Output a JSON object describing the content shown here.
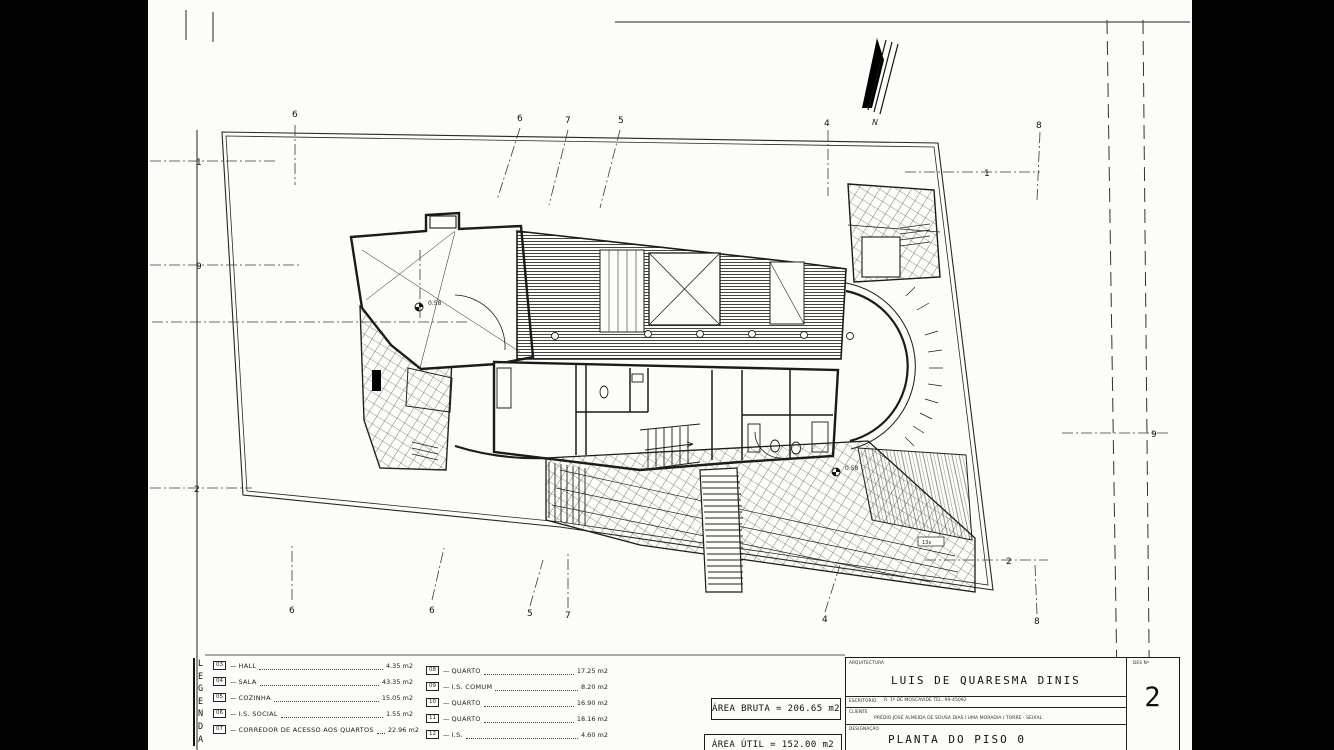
{
  "sheet": {
    "north_label": "N"
  },
  "title_block": {
    "discipline_label": "ARQUITECTURA",
    "architect_name": "LUIS DE QUARESMA DINIS",
    "office_label": "ESCRITÓRIO",
    "office_info": "R. 1º DE MOSCAVIDE   TEL. 99-45092",
    "client_label": "CLIENTE",
    "client_info": "PRÉDIO JOSÉ ALMEIDA DE SOUSA DIAS I UMA MORADIA / TORRE - SEIXAL",
    "designation_label": "DESIGNAÇÃO",
    "designation_value": "PLANTA DO PISO 0",
    "sheet_no_label": "DES Nº",
    "sheet_no": "2"
  },
  "areas": {
    "bruta": "ÁREA BRUTA = 206.65 m2",
    "util": "ÁREA ÚTIL = 152.00 m2"
  },
  "legend": {
    "title_letters": [
      "L",
      "E",
      "G",
      "E",
      "N",
      "D",
      "A"
    ],
    "col1": [
      {
        "num": "03",
        "label": "HALL",
        "area": "4.35 m2"
      },
      {
        "num": "04",
        "label": "SALA",
        "area": "43.35 m2"
      },
      {
        "num": "05",
        "label": "COZINHA",
        "area": "15.05 m2"
      },
      {
        "num": "06",
        "label": "I.S. SOCIAL",
        "area": "1.55 m2"
      },
      {
        "num": "07",
        "label": "CORREDOR DE ACESSO AOS QUARTOS",
        "area": "22.96 m2"
      }
    ],
    "col2": [
      {
        "num": "08",
        "label": "QUARTO",
        "area": "17.25 m2"
      },
      {
        "num": "09",
        "label": "I.S. COMUM",
        "area": "8.20 m2"
      },
      {
        "num": "10",
        "label": "QUARTO",
        "area": "16.90 m2"
      },
      {
        "num": "11",
        "label": "QUARTO",
        "area": "18.16 m2"
      },
      {
        "num": "12",
        "label": "I.S.",
        "area": "4.60 m2"
      }
    ]
  },
  "plan": {
    "grid_marks_top": [
      "6",
      "6",
      "7",
      "5",
      "4",
      "8"
    ],
    "grid_marks_bottom": [
      "6",
      "6",
      "5",
      "7",
      "4",
      "8"
    ],
    "grid_marks_left": [
      "1",
      "9",
      "2"
    ],
    "grid_marks_right": [
      "1",
      "9",
      "2"
    ],
    "level_mark_1": "0.58",
    "level_mark_2": "0.58",
    "stair_note": "13x"
  }
}
